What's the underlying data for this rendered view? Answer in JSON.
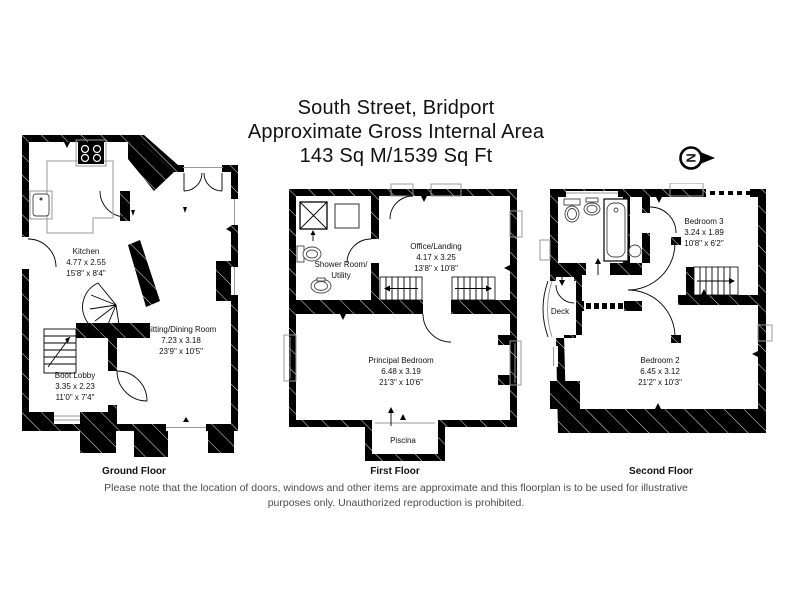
{
  "title": {
    "line1": "South Street, Bridport",
    "line2": "Approximate Gross Internal Area",
    "line3": "143 Sq M/1539 Sq Ft"
  },
  "compass": {
    "letter": "N"
  },
  "floors": [
    {
      "label": "Ground Floor",
      "rooms": [
        {
          "name": "Kitchen",
          "metric": "4.77 x 2.55",
          "imperial": "15'8\" x 8'4\""
        },
        {
          "name": "Sitting/Dining Room",
          "metric": "7.23 x 3.18",
          "imperial": "23'9\" x 10'5\""
        },
        {
          "name": "Boot Lobby",
          "metric": "3.35 x 2.23",
          "imperial": "11'0\" x 7'4\""
        }
      ]
    },
    {
      "label": "First Floor",
      "rooms": [
        {
          "name": "Shower Room/",
          "name2": "Utility"
        },
        {
          "name": "Office/Landing",
          "metric": "4.17 x 3.25",
          "imperial": "13'8\" x 10'8\""
        },
        {
          "name": "Principal Bedroom",
          "metric": "6.48 x 3.19",
          "imperial": "21'3\" x 10'6\""
        },
        {
          "name": "Piscina"
        }
      ]
    },
    {
      "label": "Second Floor",
      "rooms": [
        {
          "name": "Bedroom 3",
          "metric": "3.24 x 1.89",
          "imperial": "10'8\" x 6'2\""
        },
        {
          "name": "Deck"
        },
        {
          "name": "Bedroom 2",
          "metric": "6.45 x 3.12",
          "imperial": "21'2\" x 10'3\""
        }
      ]
    }
  ],
  "footer": {
    "line1": "Please note that the location of doors, windows and other items are approximate and this floorplan is to be used for illustrative",
    "line2": "purposes only. Unauthorized reproduction is prohibited."
  },
  "colors": {
    "wall": "#000000",
    "floor": "#ffffff",
    "frame": "#999999",
    "disclaimer": "#4c4c4c"
  }
}
